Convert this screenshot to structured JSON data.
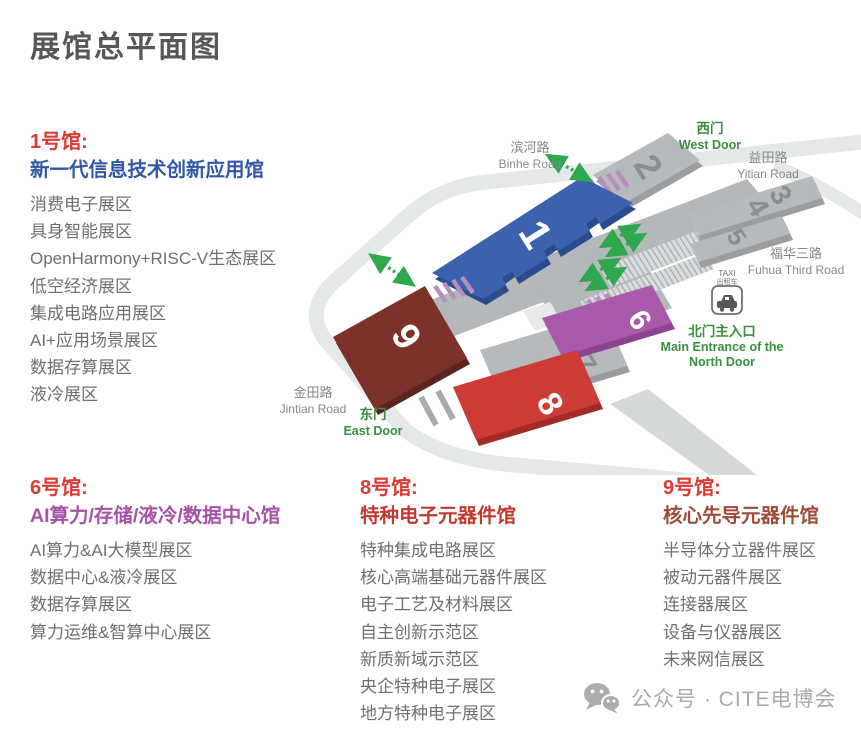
{
  "title": "展馆总平面图",
  "halls": {
    "hall1": {
      "name": "1号馆:",
      "subtitle": "新一代信息技术创新应用馆",
      "accent": "#3156A5",
      "items": [
        "消费电子展区",
        "具身智能展区",
        "OpenHarmony+RISC-V生态展区",
        "低空经济展区",
        "集成电路应用展区",
        "AI+应用场景展区",
        "数据存算展区",
        "液冷展区"
      ]
    },
    "hall6": {
      "name": "6号馆:",
      "subtitle": "AI算力/存储/液冷/数据中心馆",
      "accent": "#A751A7",
      "items": [
        "AI算力&AI大模型展区",
        "数据中心&液冷展区",
        "数据存算展区",
        "算力运维&智算中心展区"
      ]
    },
    "hall8": {
      "name": "8号馆:",
      "subtitle": "特种电子元器件馆",
      "accent": "#C0392E",
      "items": [
        "特种集成电路展区",
        "核心高端基础元器件展区",
        "电子工艺及材料展区",
        "自主创新示范区",
        "新质新域示范区",
        "央企特种电子展区",
        "地方特种电子展区"
      ]
    },
    "hall9": {
      "name": "9号馆:",
      "subtitle": "核心先导元器件馆",
      "accent": "#9E4B38",
      "items": [
        "半导体分立器件展区",
        "被动元器件展区",
        "连接器展区",
        "设备与仪器展区",
        "未来网信展区"
      ]
    }
  },
  "map": {
    "numbers": {
      "n1": "1",
      "n2": "2",
      "n3": "3",
      "n4": "4",
      "n5": "5",
      "n6": "6",
      "n7": "7",
      "n8": "8",
      "n9": "9"
    },
    "labels": {
      "binhe_cn": "滨河路",
      "binhe_en": "Binhe Road",
      "west_cn": "西门",
      "west_en": "West Door",
      "yitian_cn": "益田路",
      "yitian_en": "Yitian Road",
      "fuhua_cn": "福华三路",
      "fuhua_en": "Fuhua Third Road",
      "jintian_cn": "金田路",
      "jintian_en": "Jintian Road",
      "east_cn": "东门",
      "east_en": "East Door",
      "taxi": "TAXI",
      "taxi_cn": "出租车",
      "north_cn": "北门主入口",
      "north_en1": "Main Entrance of the",
      "north_en2": "North Door"
    },
    "colors": {
      "hall1": "#3A62AD",
      "hall6": "#A959A9",
      "hall8": "#CE3A34",
      "hall9": "#7C322B",
      "gray_hall": "#B6BABC",
      "road": "#E5E8E8",
      "green": "#2FA84D",
      "stripe": "#B68FBF"
    }
  },
  "footer": {
    "text": "公众号 · CITE电博会"
  }
}
